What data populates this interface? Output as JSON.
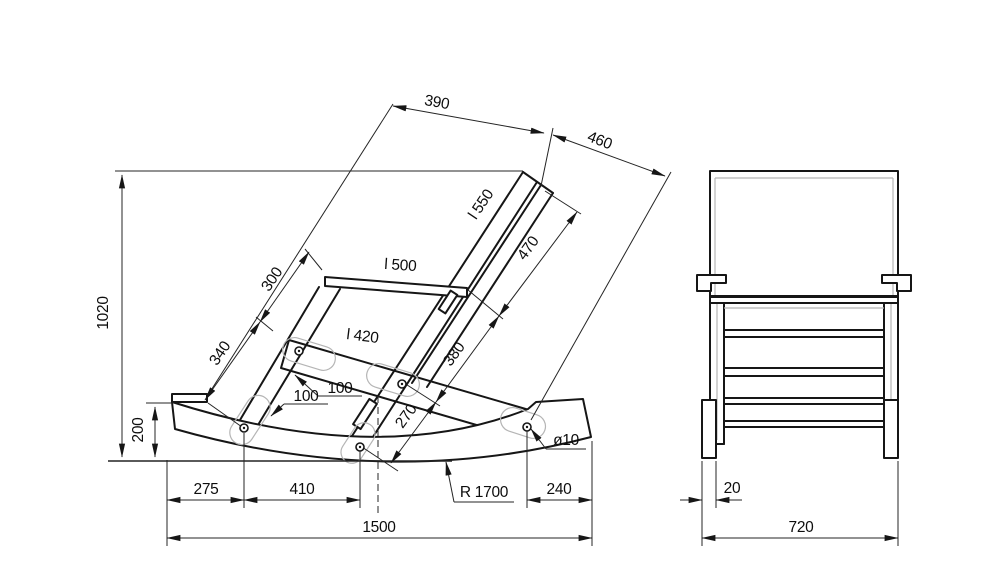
{
  "drawing": {
    "side_view": {
      "back_top_width": "390",
      "back_top_to_rocker_rear": "460",
      "overall_height": "1020",
      "back_post_length": "l 550",
      "post_top_segment": "470",
      "leg_upper_segment": "300",
      "armrest_length": "l 500",
      "leg_lower_segment": "340",
      "seat_rail_length": "l 420",
      "post_mid_segment": "380",
      "seat_slot_length": "100",
      "leg_slot_length": "100",
      "post_lower_segment": "270",
      "rocker_tip_height": "200",
      "tip_to_front_bolt": "275",
      "front_to_center_bolt": "410",
      "rocker_radius": "R 1700",
      "rear_bolt_to_tip": "240",
      "bolt_hole_diameter": "ø10",
      "overall_length": "1500"
    },
    "front_view": {
      "rocker_leg_offset": "20",
      "overall_width": "720"
    }
  }
}
